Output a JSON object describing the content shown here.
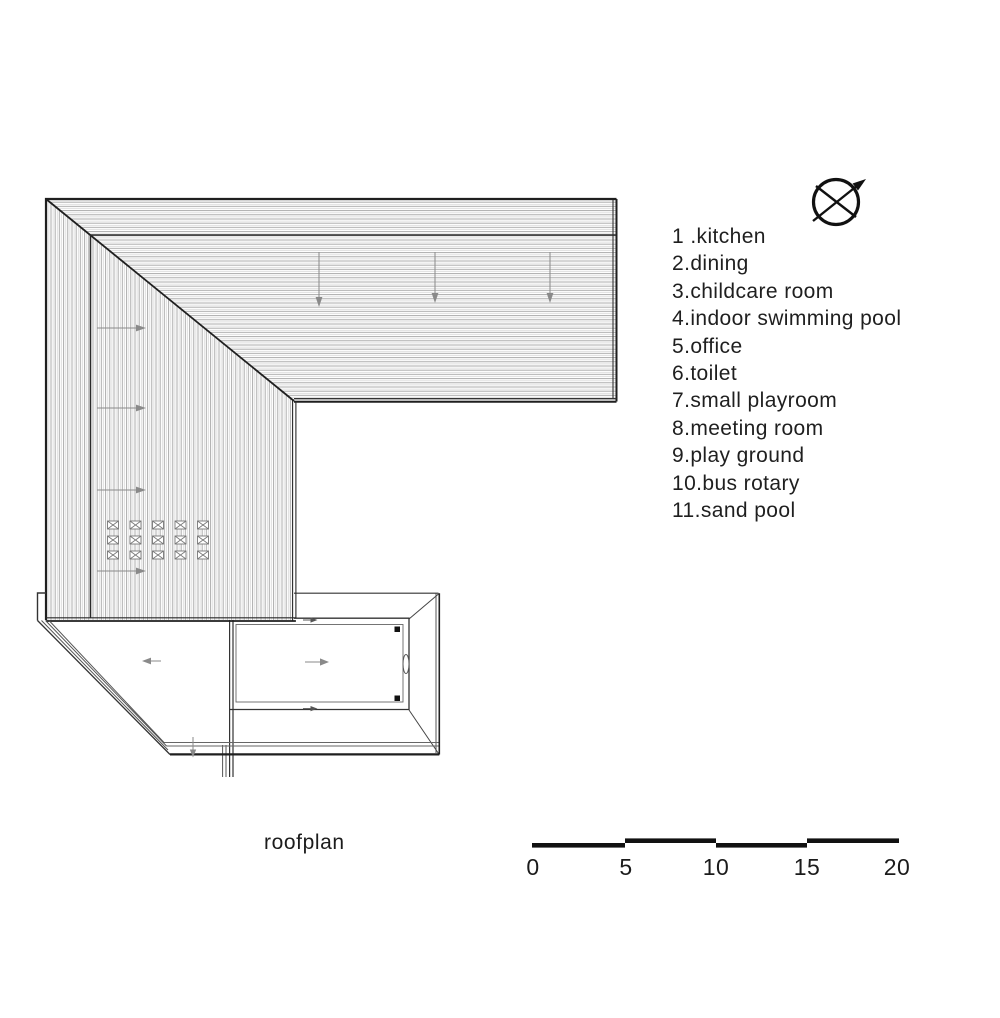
{
  "plan": {
    "title": "roofplan"
  },
  "legend": {
    "items": [
      "1 .kitchen",
      "2.dining",
      "3.childcare room",
      "4.indoor swimming pool",
      "5.office",
      "6.toilet",
      "7.small playroom",
      "8.meeting room",
      "9.play ground",
      "10.bus rotary",
      "11.sand pool"
    ]
  },
  "scalebar": {
    "labels": [
      "0",
      "5",
      "10",
      "15",
      "20"
    ]
  },
  "icons": {
    "north": "compass-north-arrow"
  },
  "colors": {
    "ink": "#1f1f1f",
    "hatch": "#a2a2a2",
    "hatch_light": "#d9d9d9",
    "arrow": "#8a8a8a",
    "bar": "#111111"
  }
}
